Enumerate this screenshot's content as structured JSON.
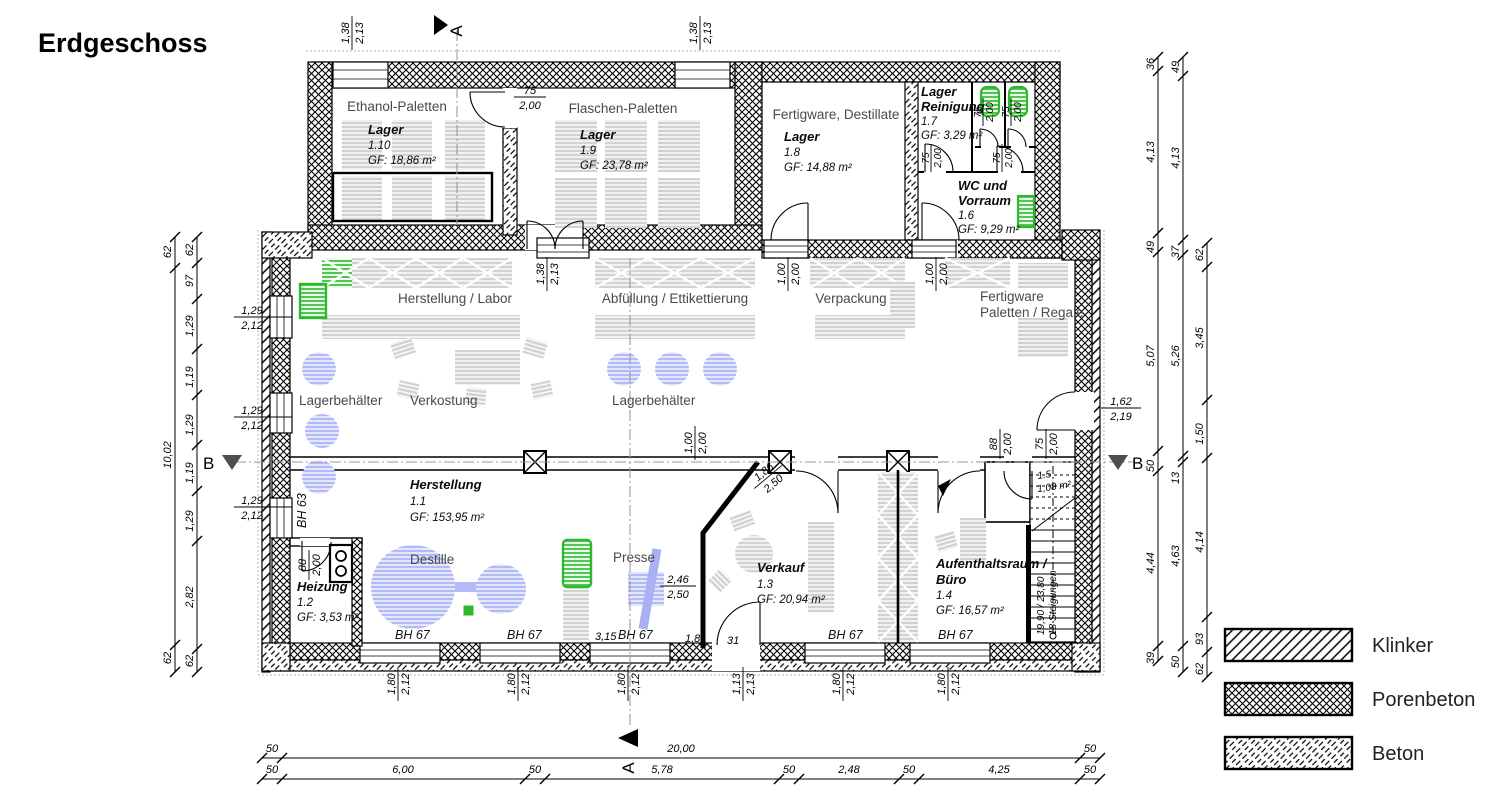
{
  "title": "Erdgeschoss",
  "legend": {
    "items": [
      "Klinker",
      "Porenbeton",
      "Beton"
    ]
  },
  "markers": {
    "a": "A",
    "b": "B"
  },
  "zones": {
    "ethanol": "Ethanol-Paletten",
    "flaschen": "Flaschen-Paletten",
    "fertigware_dest": "Fertigware, Destillate",
    "herstellung_labor": "Herstellung / Labor",
    "abfuellung": "Abfüllung / Ettikettierung",
    "verpackung": "Verpackung",
    "fertigware1": "Fertigware",
    "fertigware2": "Paletten / Regale",
    "lager1": "Lagerbehälter",
    "verkostung": "Verkostung",
    "lager2": "Lagerbehälter",
    "destille": "Destille",
    "presse": "Presse"
  },
  "rooms": {
    "r110": {
      "name": "Lager",
      "num": "1.10",
      "gf": "GF: 18,86 m²"
    },
    "r19": {
      "name": "Lager",
      "num": "1.9",
      "gf": "GF: 23,78 m²"
    },
    "r18": {
      "name": "Lager",
      "num": "1.8",
      "gf": "GF: 14,88 m²"
    },
    "r17": {
      "name": "Lager",
      "name2": "Reinigung",
      "num": "1.7",
      "gf": "GF: 3,29 m²"
    },
    "r16": {
      "name": "WC und",
      "name2": "Vorraum",
      "num": "1.6",
      "gf": "GF: 9,29 m²"
    },
    "r11": {
      "name": "Herstellung",
      "num": "1.1",
      "gf": "GF: 153,95 m²"
    },
    "r12": {
      "name": "Heizung",
      "num": "1.2",
      "gf": "GF: 3,53 m²"
    },
    "r13": {
      "name": "Verkauf",
      "num": "1.3",
      "gf": "GF: 20,94 m²"
    },
    "r14": {
      "name": "Aufenthaltsraum /",
      "name2": "Büro",
      "num": "1.4",
      "gf": "GF: 16,57 m²"
    },
    "r15": {
      "num": "1.5",
      "gf": "1,08 m²"
    }
  },
  "stairs": {
    "l1": "19,90 / 23,80",
    "l2": "18 Steigungen"
  },
  "bh": {
    "bh63": "BH 63",
    "bh67": [
      "BH 67",
      "BH 67",
      "BH 67",
      "BH 67",
      "BH 67"
    ]
  },
  "dims": {
    "top_windows": [
      [
        "1,38",
        "2,13"
      ],
      [
        "1,38",
        "2,13"
      ]
    ],
    "door_flaschen": [
      "75",
      "2,00"
    ],
    "hall_top_windows": [
      [
        "1,38",
        "2,13"
      ],
      [
        "1,00",
        "2,00"
      ],
      [
        "1,00",
        "2,00"
      ]
    ],
    "wc_doors": [
      [
        "75",
        "2,00"
      ],
      [
        "75",
        "2,00"
      ],
      [
        "75",
        "2,00"
      ],
      [
        "75",
        "2,00"
      ]
    ],
    "left_windows": [
      [
        "1,29",
        "2,12"
      ],
      [
        "1,29",
        "2,12"
      ],
      [
        "1,29",
        "2,12"
      ]
    ],
    "right_door": [
      "1,62",
      "2,19"
    ],
    "mid_doors": [
      [
        "1,00",
        "2,00"
      ],
      [
        "88",
        "2,00"
      ],
      [
        "75",
        "2,00"
      ]
    ],
    "heizung_door": [
      "88",
      "2,00"
    ],
    "presse": [
      "2,46",
      "2,50"
    ],
    "diag": [
      "1,86",
      "2,50"
    ],
    "bottom_windows": [
      [
        "1,80",
        "2,12"
      ],
      [
        "1,80",
        "2,12"
      ],
      [
        "1,80",
        "2,12"
      ],
      [
        "1,13",
        "2,13"
      ],
      [
        "1,80",
        "2,12"
      ],
      [
        "1,80",
        "2,12"
      ]
    ],
    "left_outer": [
      "62",
      "10,02",
      "62"
    ],
    "left_inner": [
      "62",
      "97",
      "1,29",
      "1,19",
      "1,29",
      "1,19",
      "1,29",
      "2,82",
      "62"
    ],
    "right_c1": [
      "36",
      "4,13",
      "49",
      "5,07",
      "50",
      "4,44",
      "39"
    ],
    "right_c2": [
      "49",
      "4,13",
      "37",
      "5,26",
      "13",
      "4,63",
      "50"
    ],
    "right_c3": [
      "62",
      "3,45",
      "1,50",
      "4,14",
      "93",
      "62"
    ],
    "bottom_total": [
      "50",
      "20,00",
      "50"
    ],
    "bottom_detail": [
      "50",
      "6,00",
      "50",
      "5,78",
      "50",
      "2,48",
      "50",
      "4,25",
      "50"
    ],
    "small": {
      "d315": "3,15",
      "d18": "1,8",
      "d31": "31"
    }
  }
}
